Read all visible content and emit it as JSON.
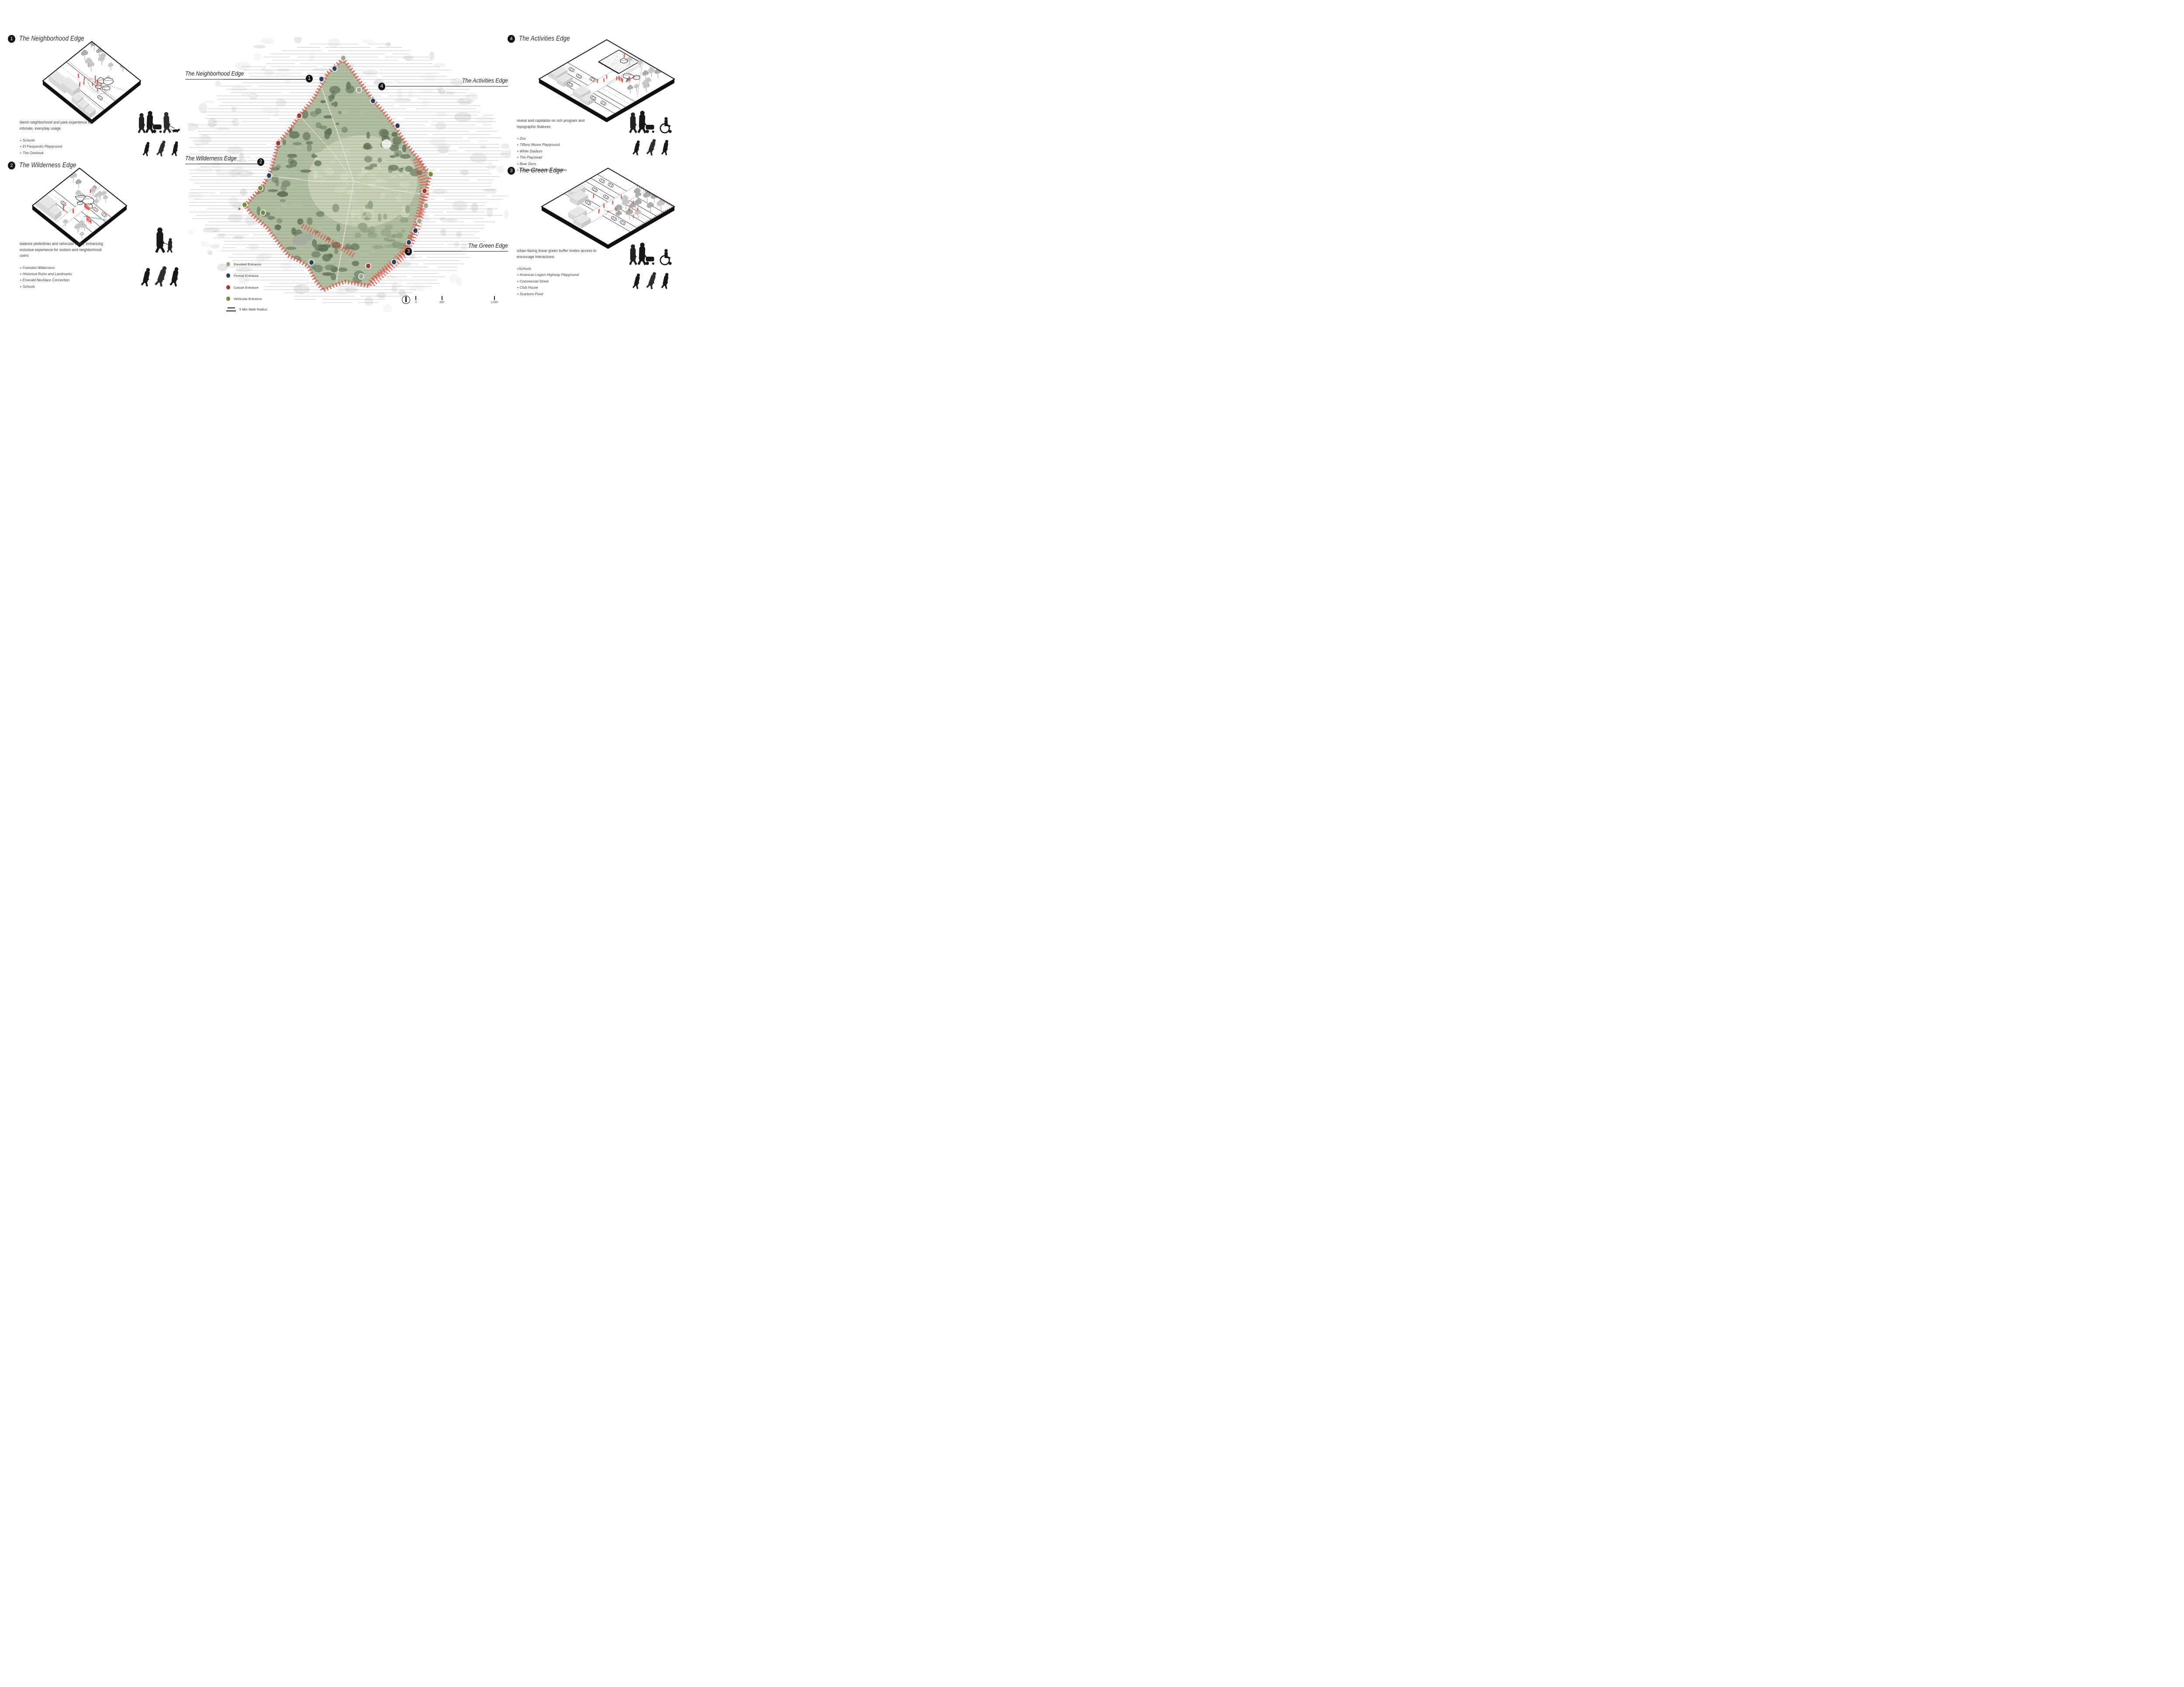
{
  "page": {
    "background": "#ffffff"
  },
  "sections": [
    {
      "id": "neighborhood",
      "number": "1",
      "title": "The Neighborhood Edge",
      "description": "blend neighborhood and park experience for intimate, everyday usage",
      "features": [
        "+ Schools",
        "+ El Parquesito Playground",
        "+ The Overlook"
      ]
    },
    {
      "id": "wilderness",
      "number": "2",
      "title": "The Wilderness Edge",
      "description": "balance pedestrian and vehicular traffic, enhancing inclusive experience for visitors and neighborhood users",
      "features": [
        "+ Forested Wilderness",
        "+ Historical Ruins and Landmarks",
        "+ Emerald Necklace Connection",
        "+ Schools"
      ]
    },
    {
      "id": "activities",
      "number": "4",
      "title": "The Activities Edge",
      "description": "reveal and capitalize on rich program and topographic features",
      "features": [
        "+ Zoo",
        "+ Tiffany Moore Playground",
        "+ White Stadium",
        "+ The Playstead",
        "+ Bear Dens",
        "+ Seasonal Festivals & Activities"
      ]
    },
    {
      "id": "green",
      "number": "3",
      "title": "The Green Edge",
      "description": "urban-facing linear green buffer invites access to encourage interactions",
      "features": [
        "+Schools",
        "+ American Legion Highway Playground",
        "+ Commercial Street",
        "+ Club House",
        "+ Scarboro Pond"
      ]
    }
  ],
  "map": {
    "labels": [
      {
        "number": "1",
        "text": "The Neighborhood Edge",
        "side": "left"
      },
      {
        "number": "2",
        "text": "The Wilderness Edge",
        "side": "left"
      },
      {
        "number": "4",
        "text": "The Activities Edge",
        "side": "right"
      },
      {
        "number": "3",
        "text": "The Green Edge",
        "side": "right"
      }
    ],
    "legend": [
      {
        "label": "Elevated Entrance",
        "color": "#a6a287",
        "type": "dot"
      },
      {
        "label": "Formal Entrance",
        "color": "#2e3f5e",
        "type": "dot"
      },
      {
        "label": "Casual Entrance",
        "color": "#a23a2b",
        "type": "dot"
      },
      {
        "label": "Vehicular Entrance",
        "color": "#7d8c33",
        "type": "dot"
      },
      {
        "label": "5 Min Walk Radius",
        "type": "lines"
      }
    ],
    "scale": {
      "ticks": [
        "0",
        "350'",
        "1,050'"
      ]
    },
    "palette": {
      "elevated": "#a6a287",
      "formal": "#2e3f5e",
      "casual": "#a23a2b",
      "vehicular": "#7d8c33",
      "edge_hatch": "#e4564b",
      "park_green": "#b0bd9e",
      "hatch_line": "#8e8e8e",
      "halo": "#e2eef5",
      "figure_red": "#e8564a",
      "silhouette": "#181818"
    }
  }
}
